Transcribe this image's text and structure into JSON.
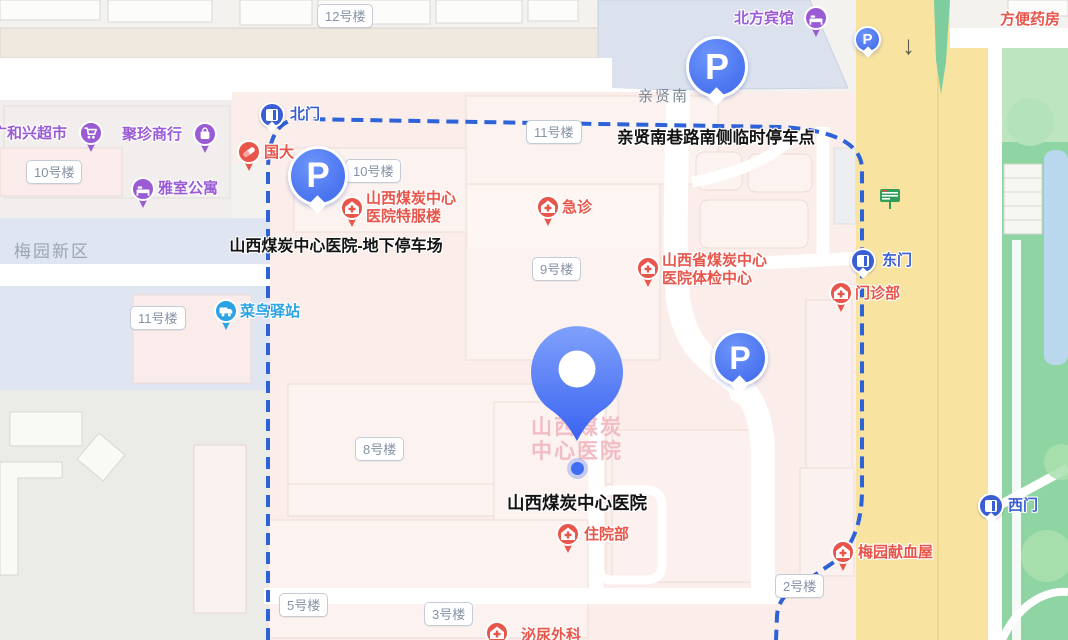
{
  "map": {
    "area_label": "梅园新区",
    "road_label": "亲贤南",
    "arrow_down": "↓",
    "pills": {
      "b12": "12号楼",
      "b11_top": "11号楼",
      "b10_campus": "10号楼",
      "b10_left": "10号楼",
      "b9": "9号楼",
      "b11_left": "11号楼",
      "b8": "8号楼",
      "b5": "5号楼",
      "b3": "3号楼",
      "b2": "2号楼"
    },
    "gates": {
      "north": "北门",
      "east": "东门",
      "west": "西门"
    },
    "hospital": {
      "main": "山西煤炭中心医院",
      "faded_line1": "山西煤炭",
      "faded_line2": "中心医院",
      "special_line1": "山西煤炭中心",
      "special_line2": "医院特服楼",
      "emergency": "急诊",
      "checkup_line1": "山西省煤炭中心",
      "checkup_line2": "医院体检中心",
      "outpatient": "门诊部",
      "inpatient": "住院部",
      "urology": "泌尿外科",
      "blood_station": "梅园献血屋"
    },
    "parking": {
      "underground_label": "山西煤炭中心医院-地下停车场",
      "roadside_label": "亲贤南巷路南侧临时停车点",
      "p_letter": "P"
    },
    "pois": {
      "supermarket": "广和兴超市",
      "shop": "聚珍商行",
      "apartment": "雅室公寓",
      "pharmacy_left": "国大",
      "cainiao": "菜鸟驿站",
      "hotel": "北方宾馆",
      "pharmacy_right": "方便药房"
    },
    "colors": {
      "boundary": "#2e62d8",
      "parking_pin": "#3b66ec",
      "poi_red": "#e8554a",
      "poi_purple": "#9a5bd5",
      "poi_cainiao": "#2aa2e3",
      "gate_blue": "#3a5ed3",
      "road_yellow": "#f8e4a0",
      "park_green": "#8fd5a3"
    }
  }
}
